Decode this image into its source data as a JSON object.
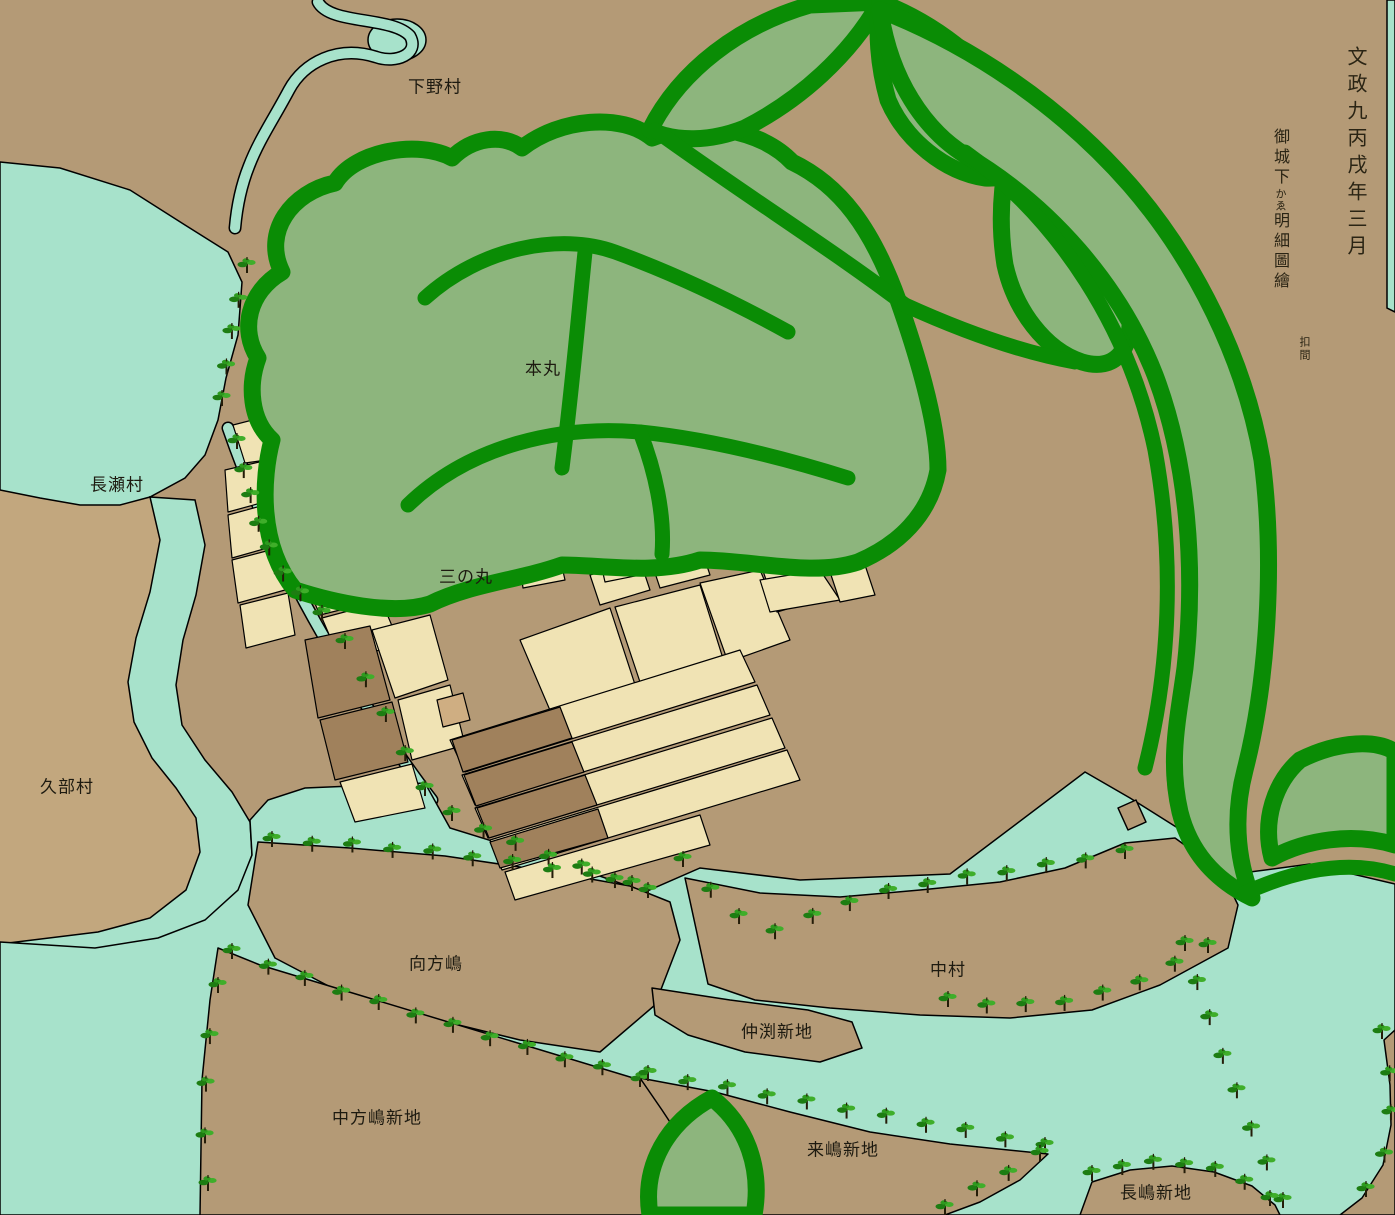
{
  "map_type": "historical-japanese-castle-town-map",
  "palette": {
    "land": "#b49a76",
    "land_light": "#c2a77e",
    "water": "#a7e2cb",
    "green_light": "#8db57d",
    "green_dark": "#0a8c05",
    "cream": "#f0e3b4",
    "block_dark": "#a0815c",
    "block_pink": "#cfae82",
    "tree_dark": "#1d7d12",
    "tree_mid": "#2d9a1e",
    "tree_light": "#3fae2a",
    "outline": "#000000",
    "text": "#1d1a10"
  },
  "annotations": {
    "date_column": "文政九丙戌年三月",
    "title_part_1": "御城下",
    "title_part_small": "かゑ",
    "title_part_2": "明細圖繪",
    "title_sub_small": "扣間"
  },
  "labels": [
    {
      "id": "shimono-mura",
      "text": "下野村",
      "x": 435,
      "y": 85
    },
    {
      "id": "nagase-mura",
      "text": "長瀬村",
      "x": 117,
      "y": 483
    },
    {
      "id": "kube-mura",
      "text": "久部村",
      "x": 67,
      "y": 785
    },
    {
      "id": "honmaru",
      "text": "本丸",
      "x": 543,
      "y": 367
    },
    {
      "id": "sannomaru",
      "text": "三の丸",
      "x": 466,
      "y": 575
    },
    {
      "id": "mukaikata-jima",
      "text": "向方嶋",
      "x": 436,
      "y": 962
    },
    {
      "id": "naka-mura",
      "text": "中村",
      "x": 948,
      "y": 968
    },
    {
      "id": "nakabuchi-shinchi",
      "text": "仲渕新地",
      "x": 777,
      "y": 1030
    },
    {
      "id": "nakakatajima-shinchi",
      "text": "中方嶋新地",
      "x": 377,
      "y": 1116
    },
    {
      "id": "kurashima-shinchi",
      "text": "来嶋新地",
      "x": 843,
      "y": 1148
    },
    {
      "id": "nagashima-shinchi",
      "text": "長嶋新地",
      "x": 1156,
      "y": 1191
    }
  ]
}
